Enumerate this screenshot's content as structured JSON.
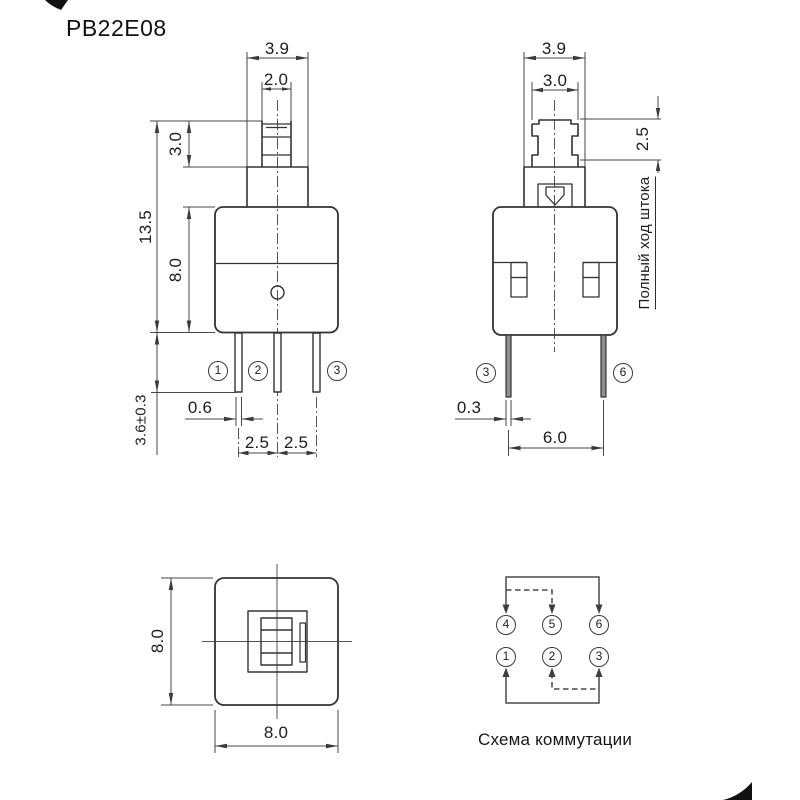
{
  "title": "PB22E08",
  "colors": {
    "background": "#ffffff",
    "object_line": "#333333",
    "dim_line": "#474747",
    "text": "#1e1e1e"
  },
  "front_view": {
    "dim_shaft_width": "3.9",
    "dim_plunger_width": "2.0",
    "dim_plunger_height": "3.0",
    "dim_total_height": "13.5",
    "dim_body_height": "8.0",
    "dim_pin_length": "3.6±0.3",
    "dim_pin_width": "0.6",
    "dim_pin_pitch_a": "2.5",
    "dim_pin_pitch_b": "2.5",
    "pin_labels": {
      "p1": "1",
      "p2": "2",
      "p3": "3"
    }
  },
  "side_view": {
    "dim_shaft_width": "3.9",
    "dim_plunger_width": "3.0",
    "dim_stroke": "2.5",
    "stroke_caption": "Полный ход штока",
    "dim_pin_thickness": "0.3",
    "dim_pin_span": "6.0",
    "pin_labels": {
      "p3": "3",
      "p6": "6"
    }
  },
  "bottom_view": {
    "dim_width": "8.0",
    "dim_height": "8.0"
  },
  "schematic": {
    "caption": "Схема коммутации",
    "pins_top": {
      "p4": "4",
      "p5": "5",
      "p6": "6"
    },
    "pins_bottom": {
      "p1": "1",
      "p2": "2",
      "p3": "3"
    }
  }
}
